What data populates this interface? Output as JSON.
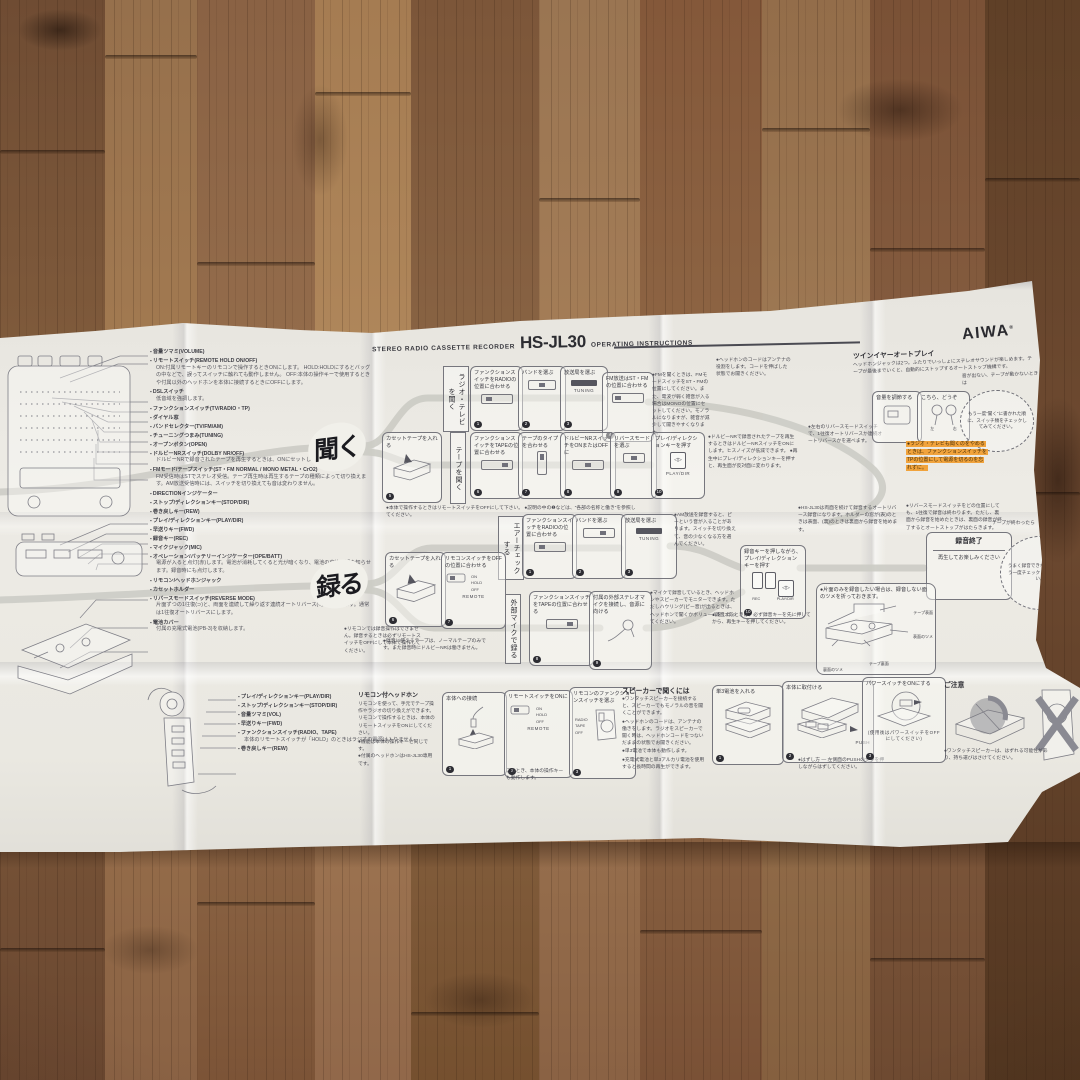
{
  "meta": {
    "brand": "AIWA",
    "reg": "®",
    "product_line": "STEREO RADIO CASSETTE RECORDER",
    "model": "HS-JL30",
    "doc_type": "OPERATING INSTRUCTIONS"
  },
  "glyphs": {
    "play_dir": "◁▷"
  },
  "parts": {
    "title": "●各部の名称と働き",
    "items": [
      {
        "label": "音量ツマミ(VOLUME)"
      },
      {
        "label": "リモートスイッチ(REMOTE HOLD ON/OFF)",
        "desc": "ON:付属リモートキーのリモコンで操作するときONにします。 HOLD:HOLDにするとバッグの中などで、誤ってスイッチに触れても動作しません。 OFF:本体の操作キーで使用するときや付属以外のヘッドホンを本体に接続するときにOFFにします。"
      },
      {
        "label": "DSLスイッチ",
        "desc": "低音域を強調します。"
      },
      {
        "label": "ファンクションスイッチ(TV/RADIO・TP)"
      },
      {
        "label": "ダイヤル窓"
      },
      {
        "label": "バンドセレクター(TV/FM/AM)"
      },
      {
        "label": "チューニングつまみ(TUNING)"
      },
      {
        "label": "オープンボタン(OPEN)"
      },
      {
        "label": "ドルビーNRスイッチ(DOLBY NR/OFF)",
        "desc": "ドルビーNRで録音されたテープを再生するときは、ONにセットします。"
      },
      {
        "label": "FMモード/テープスイッチ(ST・FM NORMAL / MONO METAL・CrO2)",
        "desc": "FM受信時はSTでステレオ受信。テープ再生時は再生するテープの種類によって切り換えます。AM放送受信時には、スイッチを切り換えても音は変わりません。"
      },
      {
        "label": "DIRECTIONインジケーター"
      },
      {
        "label": "ストップ/ディレクションキー(STOP/DIR)"
      },
      {
        "label": "巻き戻しキー(REW)"
      },
      {
        "label": "プレイ/ディレクションキー(PLAY/DIR)"
      },
      {
        "label": "早送りキー(FWD)"
      },
      {
        "label": "録音キー(REC)"
      },
      {
        "label": "マイクジャック(MIC)"
      },
      {
        "label": "オペレーション/バッテリーインジケーター(OPE/BATT)",
        "desc": "電源が入ると点灯(赤)します。電池が消耗してくると光が暗くなり、電池の交換時期を知らせます。録音時にも点灯します。"
      },
      {
        "label": "リモコン/ヘッドホンジャック"
      },
      {
        "label": "カセットホルダー"
      },
      {
        "label": "リバースモードスイッチ(REVERSE MODE)",
        "desc": "片面ずつの1往復(⊃)と、両面を連続して繰り返す連続オートリバース(○)かを選びます。通常は1往復オートリバースにします。"
      },
      {
        "label": "電池カバー",
        "desc": "付属の充電式電池(PB-3)を収納します。"
      }
    ]
  },
  "listen": {
    "badge": "聞く",
    "note_top": "●本体で操作するときはリモートスイッチをOFFにして下さい。 ●説明の中の❶などは、“各部の名称と働き”を参照してください。",
    "radio_row": {
      "label": "ラジオ・テレビを聞く",
      "steps": [
        {
          "num": "1",
          "text": "ファンクションスイッチをRADIOの位置に合わせる"
        },
        {
          "num": "2",
          "text": "バンドを選ぶ"
        },
        {
          "num": "3",
          "text": "放送局を選ぶ",
          "sub": "TUNING"
        },
        {
          "num": "4",
          "text": "FM放送はST・FMの位置に合わせる"
        }
      ],
      "notes": [
        "●FMを聞くときは、FMモードスイッチをST・FMの位置にしてください。また、電波が弱く雑音が入る場合はMONOの位置にセットしてください。モノラルになりますが、雑音が減少して聞きやすくなります。",
        "●ヘッドホンのコードはアンテナの役割をします。コードを伸ばした状態でお聞きください。"
      ]
    },
    "tape_row": {
      "label": "テープを聞く",
      "pre": {
        "num": "5",
        "text": "カセットテープを入れる"
      },
      "steps": [
        {
          "num": "6",
          "text": "ファンクションスイッチをTAPEの位置に合わせる"
        },
        {
          "num": "7",
          "text": "テープのタイプを合わせる"
        },
        {
          "num": "8",
          "text": "ドルビーNRスイッチをONまたはOFFに"
        },
        {
          "num": "9",
          "text": "リバースモードを選ぶ"
        },
        {
          "num": "10",
          "text": "プレイ/ディレクションキーを押す",
          "sub": "PLAY/DIR"
        }
      ],
      "notes": [
        "●ドルビーNRで録音されたテープを再生するときはドルビーNRスイッチをONにします。ヒスノイズが低減できます。 ●再生中にプレイ/ディレクションキーを押すと、再生面が反対面に変わります。",
        "●左右のリバースモードスイッチで、1往復オートリバースか連続オートリバースかを選べます。"
      ]
    }
  },
  "record": {
    "badge": "録る",
    "side_note": "●リモコンでは録音操作はできません。録音するときは必ずリモートスイッチをOFFにして本体で操作してください。",
    "aircheck": {
      "label": "エアーチェックする",
      "steps": [
        {
          "num": "1",
          "text": "ファンクションスイッチをRADIOの位置に合わせる"
        },
        {
          "num": "2",
          "text": "バンドを選ぶ"
        },
        {
          "num": "3",
          "text": "放送局を選ぶ",
          "sub": "TUNING"
        }
      ],
      "note": "●AM放送を録音すると、ピーという音が入ることがあります。スイッチを切り換えて、音の少なくなる方を選んでください。"
    },
    "load": {
      "steps": [
        {
          "num": "6",
          "text": "カセットテープを入れる"
        },
        {
          "num": "7",
          "text": "リモコンスイッチをOFFの位置に合わせる",
          "sub": "REMOTE"
        }
      ],
      "switch_labels": [
        "ON",
        "HOLD",
        "OFF"
      ],
      "note": "●録音に使えるテープは、ノーマルテープのみです。また録音時にドルビーNRは働きません。"
    },
    "mic": {
      "label": "外部マイクで録る",
      "steps": [
        {
          "num": "8",
          "text": "ファンクションスイッチをTAPEの位置に合わせる"
        },
        {
          "num": "9",
          "text": "付属の外部ステレオマイクを接続し、音源に向ける"
        }
      ],
      "note": "●マイクで録音しているとき、ヘッドホンやスピーカーでモニターできます。ただしハウリング(ピー音)が出るときは、ヘッドホンで聞くかボリュームをしぼってください。"
    },
    "rec": {
      "num": "10",
      "text": "録音キーを押しながら、プレイ/ディレクションキーを押す",
      "key_labels": [
        "REC",
        "PLAY/DIR"
      ],
      "note": "●録音するときは、必ず録音キーを先に押してから、再生キーを押してください。"
    },
    "notes_top": [
      "●HS-JL30は両面を続けて録音するオートリバース録音になります。ホルダーの窓が(表)のときは表面、(裏)のときは裏面から録音を始めます。",
      "●リバースモードスイッチをどの位置にしても、1往復で録音は終わります。ただし、裏面から録音を始めたときは、裏面の録音が終了するとオートストップがはたらきます。"
    ],
    "done": {
      "title": "録音終了",
      "text": "再生してお楽しみください"
    },
    "circle_pre": "テープが終わったら",
    "circle_note": "うまく録音できないときは、もう一度チェックしてみてください。",
    "tab_note": "●片面のみを録音したい場合は、録音しない面のツメを折っておきます。",
    "tab_labels": [
      "テープ表面",
      "表面のツメ",
      "裏面のツメ",
      "テープ裏面"
    ]
  },
  "feature": {
    "heading": "ツインイヤーオートプレイ",
    "body": "ヘッドホンジャックは2つ。ふたりでいっしょにステレオサウンドが楽しめます。テープが最後までいくと、自動的にストップするオートストップ機構です。",
    "box1": "音量を調節する",
    "box2": "こちら、どうぞ",
    "ear_labels": [
      "左",
      "右"
    ],
    "circle_pre": "音が出ない、テープが動かないときは",
    "circle_note": "もう一度“聞く”に書かれた順に、スイッチ類をチェックしてみてください。"
  },
  "highlight": {
    "text": "●ラジオ・テレビも聞くのをやめるときは、ファンクションスイッチをTPの位置にして電源を切るのを忘れずに。",
    "color": "#f1a33c"
  },
  "remote": {
    "heading": "リモコン付ヘッドホン",
    "body": "リモコンを使って、手元でテープ操作やラジオの切り換えができます。リモコンで操作するときは、本体のリモートスイッチをONにしてください。",
    "notes": [
      "●機能は本体の操作キーと同じです。",
      "●付属のヘッドホンはHS-JL30専用です。"
    ],
    "callouts": [
      "プレイ/ディレクションキー(PLAY/DIR)",
      "ストップ/ディレクションキー(STOP/DIR)",
      "音量ツマミ(VOL)",
      "早送りキー(FWD)",
      "ファンクションスイッチ(RADIO、TAPE)",
      "巻き戻しキー(REW)"
    ],
    "callout_note": "本体のリモートスイッチが「HOLD」のときはラジオの電源は入りません。",
    "steps": [
      {
        "num": "1",
        "title": "本体への接続"
      },
      {
        "num": "2",
        "title": "リモートスイッチをONに",
        "sub": "REMOTE",
        "switch_labels": [
          "ON",
          "HOLD",
          "OFF"
        ]
      },
      {
        "num": "3",
        "title": "リモコンのファンクションスイッチを選ぶ",
        "switch_labels": [
          "RADIO",
          "TAPE",
          "OFF"
        ]
      }
    ],
    "step2_note": "このとき、本体の操作キーも動作します。"
  },
  "speaker": {
    "heading": "スピーカーで聞くには",
    "notes": [
      "●ワンタッチスピーカーを接続すると、スピーカーでもモノラルの音を聞くことができます。",
      "●ヘッドホンのコードは、アンテナの働きをします。ラジオをスピーカーで聞く時は、ヘッドホンコードをつないだままの状態でお聞きください。",
      "●単3電池で本体も動作します。",
      "●充電式電池と単3アルカリ電池を使用すると長時間の再生ができます。"
    ],
    "steps": [
      {
        "num": "1",
        "title": "単3電池を入れる"
      },
      {
        "num": "2",
        "title": "本体に取付ける",
        "sub": "PUSH"
      },
      {
        "num": "3",
        "title": "パワースイッチをONにする",
        "sub": "(使用後はパワースイッチをOFFにしてください)"
      }
    ],
    "remove_note": "●はずし方 — 左側面のPUSHの文字を押しながらはずしてください。"
  },
  "caution": {
    "heading": "ご注意",
    "note": "●ワンタッチスピーカーは、はずれる可能性があり、持ち運びはさけてください。"
  }
}
